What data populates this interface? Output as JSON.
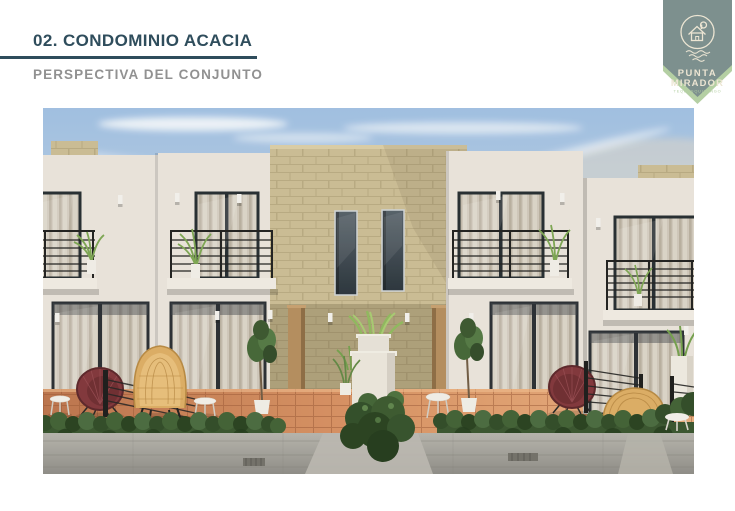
{
  "slide": {
    "header": {
      "title": "02. CONDOMINIO ACACIA",
      "subtitle": "PERSPECTIVA DEL CONJUNTO"
    },
    "logo": {
      "line1": "PUNTA",
      "line2": "MIRADOR",
      "tagline": "TEQUESQUITENGO",
      "emblem": "house-over-water-icon"
    },
    "colors": {
      "title": "#2f4d5c",
      "underline": "#2f4d5c",
      "subtitle": "#919191",
      "logo_badge": "#7d908e",
      "logo_band": "#b4cfa3",
      "logo_text": "#ece5d3",
      "sky_top": "#9dbde2",
      "stucco": "#e8e2db",
      "brick": "#c9ba92",
      "brick_mortar": "#b1a27a",
      "terracotta": "#cd8457",
      "hedge": "#33502a",
      "sidewalk": "#a19f99",
      "railing": "#1a1a1a",
      "chair_maroon": "#7d3036",
      "chair_rattan": "#dbaa60",
      "door_wood": "#b2895a",
      "window_frame": "#23282e",
      "plant_green": "#86b054"
    }
  }
}
